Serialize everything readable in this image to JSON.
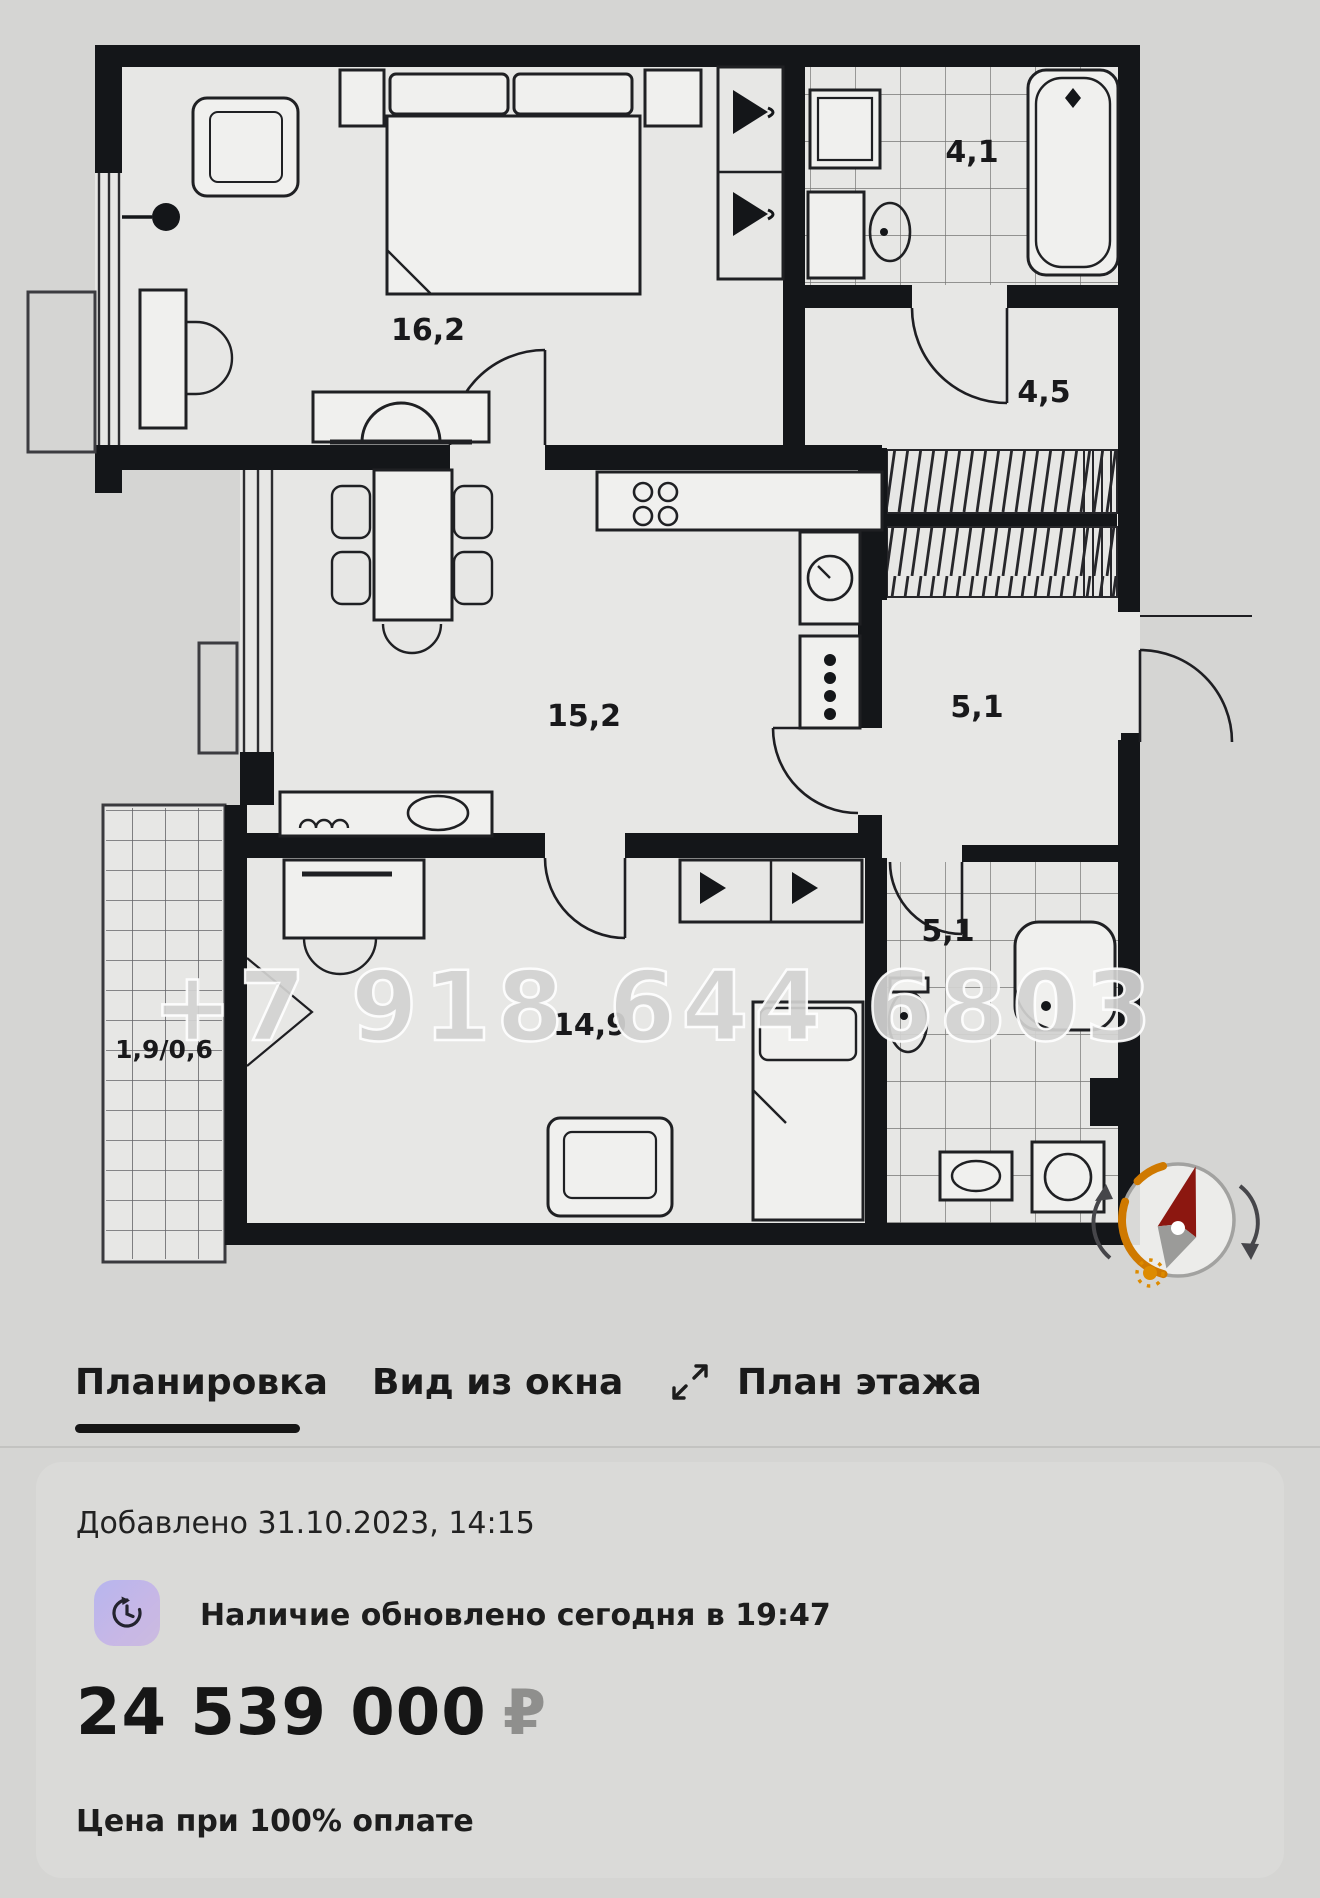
{
  "floor_plan": {
    "watermark": "+7 918 644 6803",
    "rooms": [
      {
        "id": "bedroom-top",
        "label": "16,2"
      },
      {
        "id": "bathroom-top",
        "label": "4,1"
      },
      {
        "id": "hallway",
        "label": "4,5"
      },
      {
        "id": "kitchen-living",
        "label": "15,2"
      },
      {
        "id": "corridor",
        "label": "5,1"
      },
      {
        "id": "bedroom-bottom",
        "label": "14,9"
      },
      {
        "id": "bathroom-bottom",
        "label": "5,1"
      },
      {
        "id": "balcony",
        "label": "1,9/0,6"
      }
    ],
    "compass": {
      "north_color": "#8c1710",
      "arc_color": "#cf7900",
      "sun_color": "#dd8b00"
    }
  },
  "tabs": {
    "items": [
      {
        "label": "Планировка",
        "active": true
      },
      {
        "label": "Вид из окна",
        "active": false
      },
      {
        "label": "План этажа",
        "active": false
      }
    ]
  },
  "card": {
    "added_label": "Добавлено 31.10.2023, 14:15",
    "availability_text": "Наличие обновлено сегодня в 19:47",
    "price_value": "24 539 000",
    "currency_symbol": "₽",
    "price_note": "Цена при 100% оплате"
  },
  "colors": {
    "wall": "#141619",
    "accent_underline": "#151515",
    "card_bg": "#dadad8"
  }
}
